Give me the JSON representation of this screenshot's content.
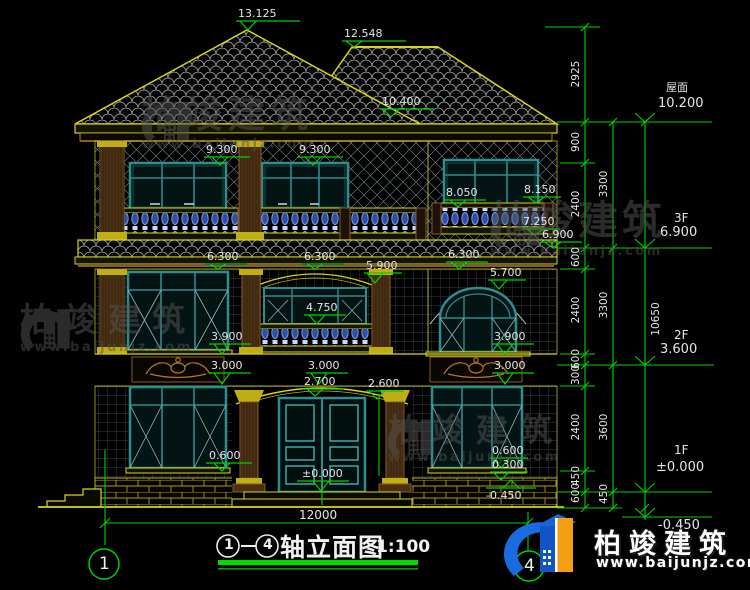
{
  "drawing": {
    "title": {
      "axis_from": "1",
      "axis_to": "4",
      "name": "轴立面图",
      "scale": "1:100"
    },
    "axis_bubbles": {
      "left": "1",
      "right": "4"
    },
    "overall_width_dim": "12000",
    "level_marks": [
      "13.125",
      "12.548",
      "10.400",
      "9.300",
      "9.300",
      "8.050",
      "8.150",
      "7.250",
      "6.900",
      "6.300",
      "6.300",
      "6.300",
      "5.900",
      "5.700",
      "4.750",
      "3.900",
      "3.900",
      "3.000",
      "3.000",
      "3.000",
      "2.700",
      "2.600",
      "0.600",
      "0.600",
      "0.300",
      "±0.000",
      "-0.450"
    ],
    "right_levels": {
      "roof_label": "屋面",
      "roof": "10.200",
      "f3_label": "3F",
      "f3": "6.900",
      "f2_label": "2F",
      "f2": "3.600",
      "f1_label": "1F",
      "f1": "±0.000",
      "below": "-0.450",
      "total": "10650"
    },
    "chain_inner": [
      "2925",
      "900",
      "2400",
      "600",
      "2400",
      "600",
      "300",
      "2400",
      "450",
      "600"
    ],
    "chain_outer": [
      "3300",
      "3300",
      "3600",
      "450"
    ]
  },
  "watermark": {
    "brand": "柏竣建筑",
    "url": "www.baijunjz.com"
  },
  "logo": {
    "brand": "柏竣建筑",
    "url": "www.baijunjz.com"
  }
}
